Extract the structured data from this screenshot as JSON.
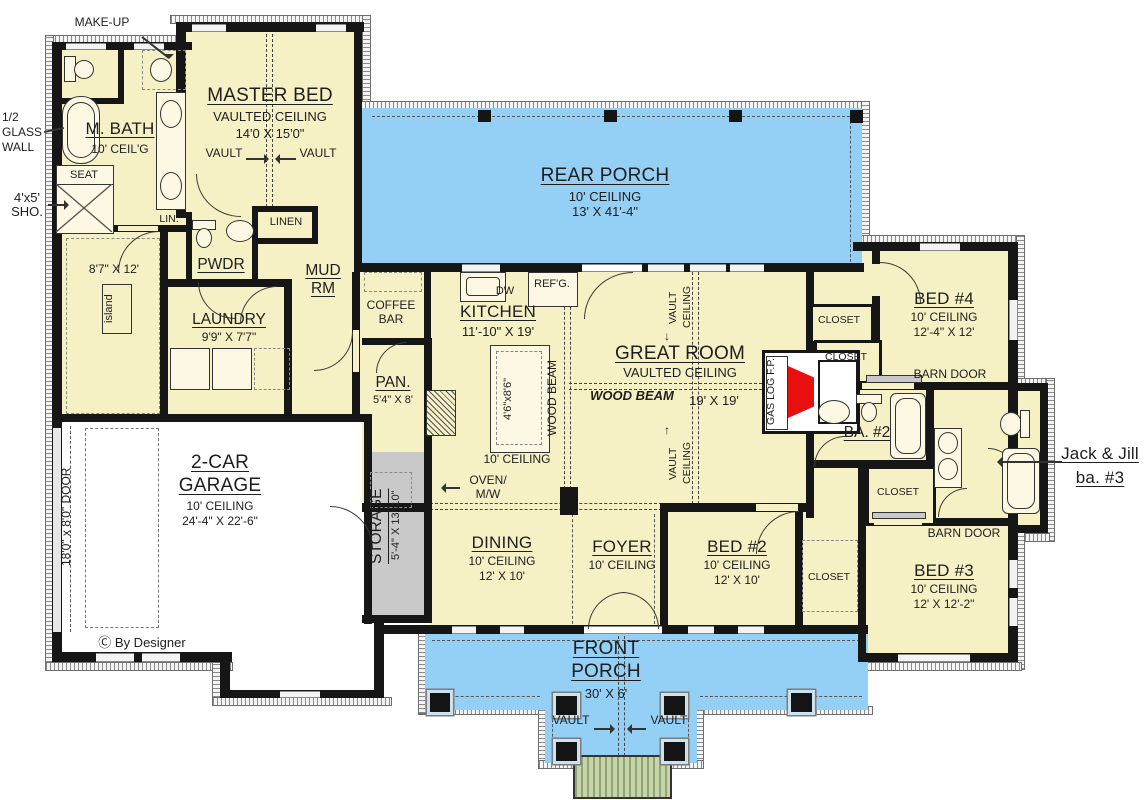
{
  "colors": {
    "room_fill": "#F6F0C5",
    "porch_fill": "#94CFF5",
    "storage_fill": "#C9C9C9",
    "garage_fill": "#FFFFFF",
    "wall": "#161616",
    "fireplace_red": "#E90F0F",
    "steps_green": "#C6D4A8"
  },
  "shared": {
    "closet": "CLOSET",
    "vault": "VAULT",
    "vault_word": "VAULT",
    "ceiling_word": "CEILING",
    "vaulted_ceiling": "VAULTED CEILING",
    "barn_door": "BARN DOOR",
    "wood_beam": "WOOD BEAM",
    "ceiling_10": "10' CEILING",
    "arrow_right": "→",
    "arrow_left": "←",
    "arrow_up": "↑",
    "arrow_down": "↓"
  },
  "annotations": {
    "make_up": "MAKE-UP",
    "half_glass_wall": "1/2 GLASS WALL",
    "shower_line1": "4'x5'",
    "shower_line2": "SHO.",
    "seat": "SEAT",
    "lin": "LIN.",
    "linen": "LINEN",
    "island": "island",
    "dw": "DW",
    "refg": "REF'G.",
    "oven_line1": "OVEN/",
    "oven_line2": "M/W",
    "gas_log_fp": "GAS LOG F.P.",
    "jack_jill_line1": "Jack & Jill",
    "jack_jill_line2": "ba. #3",
    "copyright": "Ⓒ By Designer"
  },
  "rooms": {
    "master_bed": {
      "name": "MASTER BED",
      "ceiling": "VAULTED CEILING",
      "dims": "14'0 X 15'0\""
    },
    "m_bath": {
      "name": "M. BATH",
      "ceiling": "10' CEIL'G"
    },
    "master_closet": {
      "dims": "8'7\" X 12'"
    },
    "pwdr": {
      "name": "PWDR"
    },
    "mud_rm": {
      "line1": "MUD",
      "line2": "RM"
    },
    "laundry": {
      "name": "LAUNDRY",
      "dims": "9'9\" X 7'7\""
    },
    "rear_porch": {
      "name": "REAR PORCH",
      "ceiling": "10' CEILING",
      "dims": "13' X 41'-4\""
    },
    "coffee_bar": {
      "line1": "COFFEE",
      "line2": "BAR"
    },
    "kitchen": {
      "name": "KITCHEN",
      "dims": "11'-10\" X 19'",
      "island_dims": "4'6\"x8'6\"",
      "ceiling": "10' CEILING"
    },
    "pan": {
      "name": "PAN.",
      "dims": "5'4\" X 8'"
    },
    "storage": {
      "name": "STORAGE",
      "dims": "5'-4\" X 13'-10\""
    },
    "great_room": {
      "name": "GREAT ROOM",
      "ceiling": "VAULTED CEILING",
      "dims": "19' X 19'"
    },
    "garage": {
      "line1": "2-CAR",
      "line2": "GARAGE",
      "ceiling": "10' CEILING",
      "dims": "24'-4\" X 22'-6\"",
      "door": "18'0\" x 8'0\" DOOR"
    },
    "dining": {
      "name": "DINING",
      "ceiling": "10' CEILING",
      "dims": "12' X 10'"
    },
    "foyer": {
      "name": "FOYER",
      "ceiling": "10' CEILING"
    },
    "bed2": {
      "name": "BED #2",
      "ceiling": "10' CEILING",
      "dims": "12' X 10'"
    },
    "bed3": {
      "name": "BED #3",
      "ceiling": "10' CEILING",
      "dims": "12' X 12'-2\""
    },
    "bed4": {
      "name": "BED #4",
      "ceiling": "10' CEILING",
      "dims": "12'-4\" X 12'"
    },
    "ba2": {
      "name": "BA. #2"
    },
    "front_porch": {
      "line1": "FRONT",
      "line2": "PORCH",
      "dims": "30' X 6'"
    }
  }
}
